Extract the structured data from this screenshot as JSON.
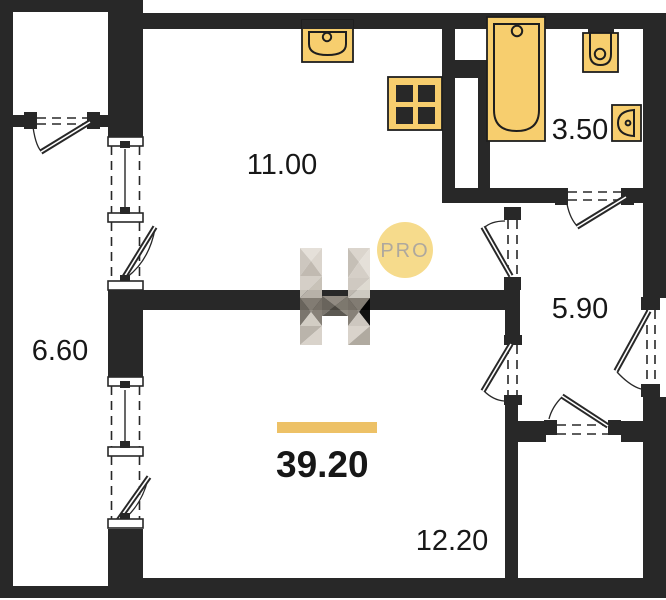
{
  "areas": {
    "kitchen_living": "11.00",
    "bathroom": "3.50",
    "balcony": "6.60",
    "hallway": "5.90",
    "room": "12.20",
    "total": "39.20"
  },
  "watermark": {
    "badge": "PRO"
  },
  "colors": {
    "wall_color": "#282828",
    "label_color": "#171717",
    "accent": "#edc166",
    "fixture_fill": "#f7ce6e",
    "fixture_outline": "#1e1e1e",
    "badge_fill": "#f6d883",
    "badge_text": "#a8a196",
    "bg": "#ffffff"
  }
}
